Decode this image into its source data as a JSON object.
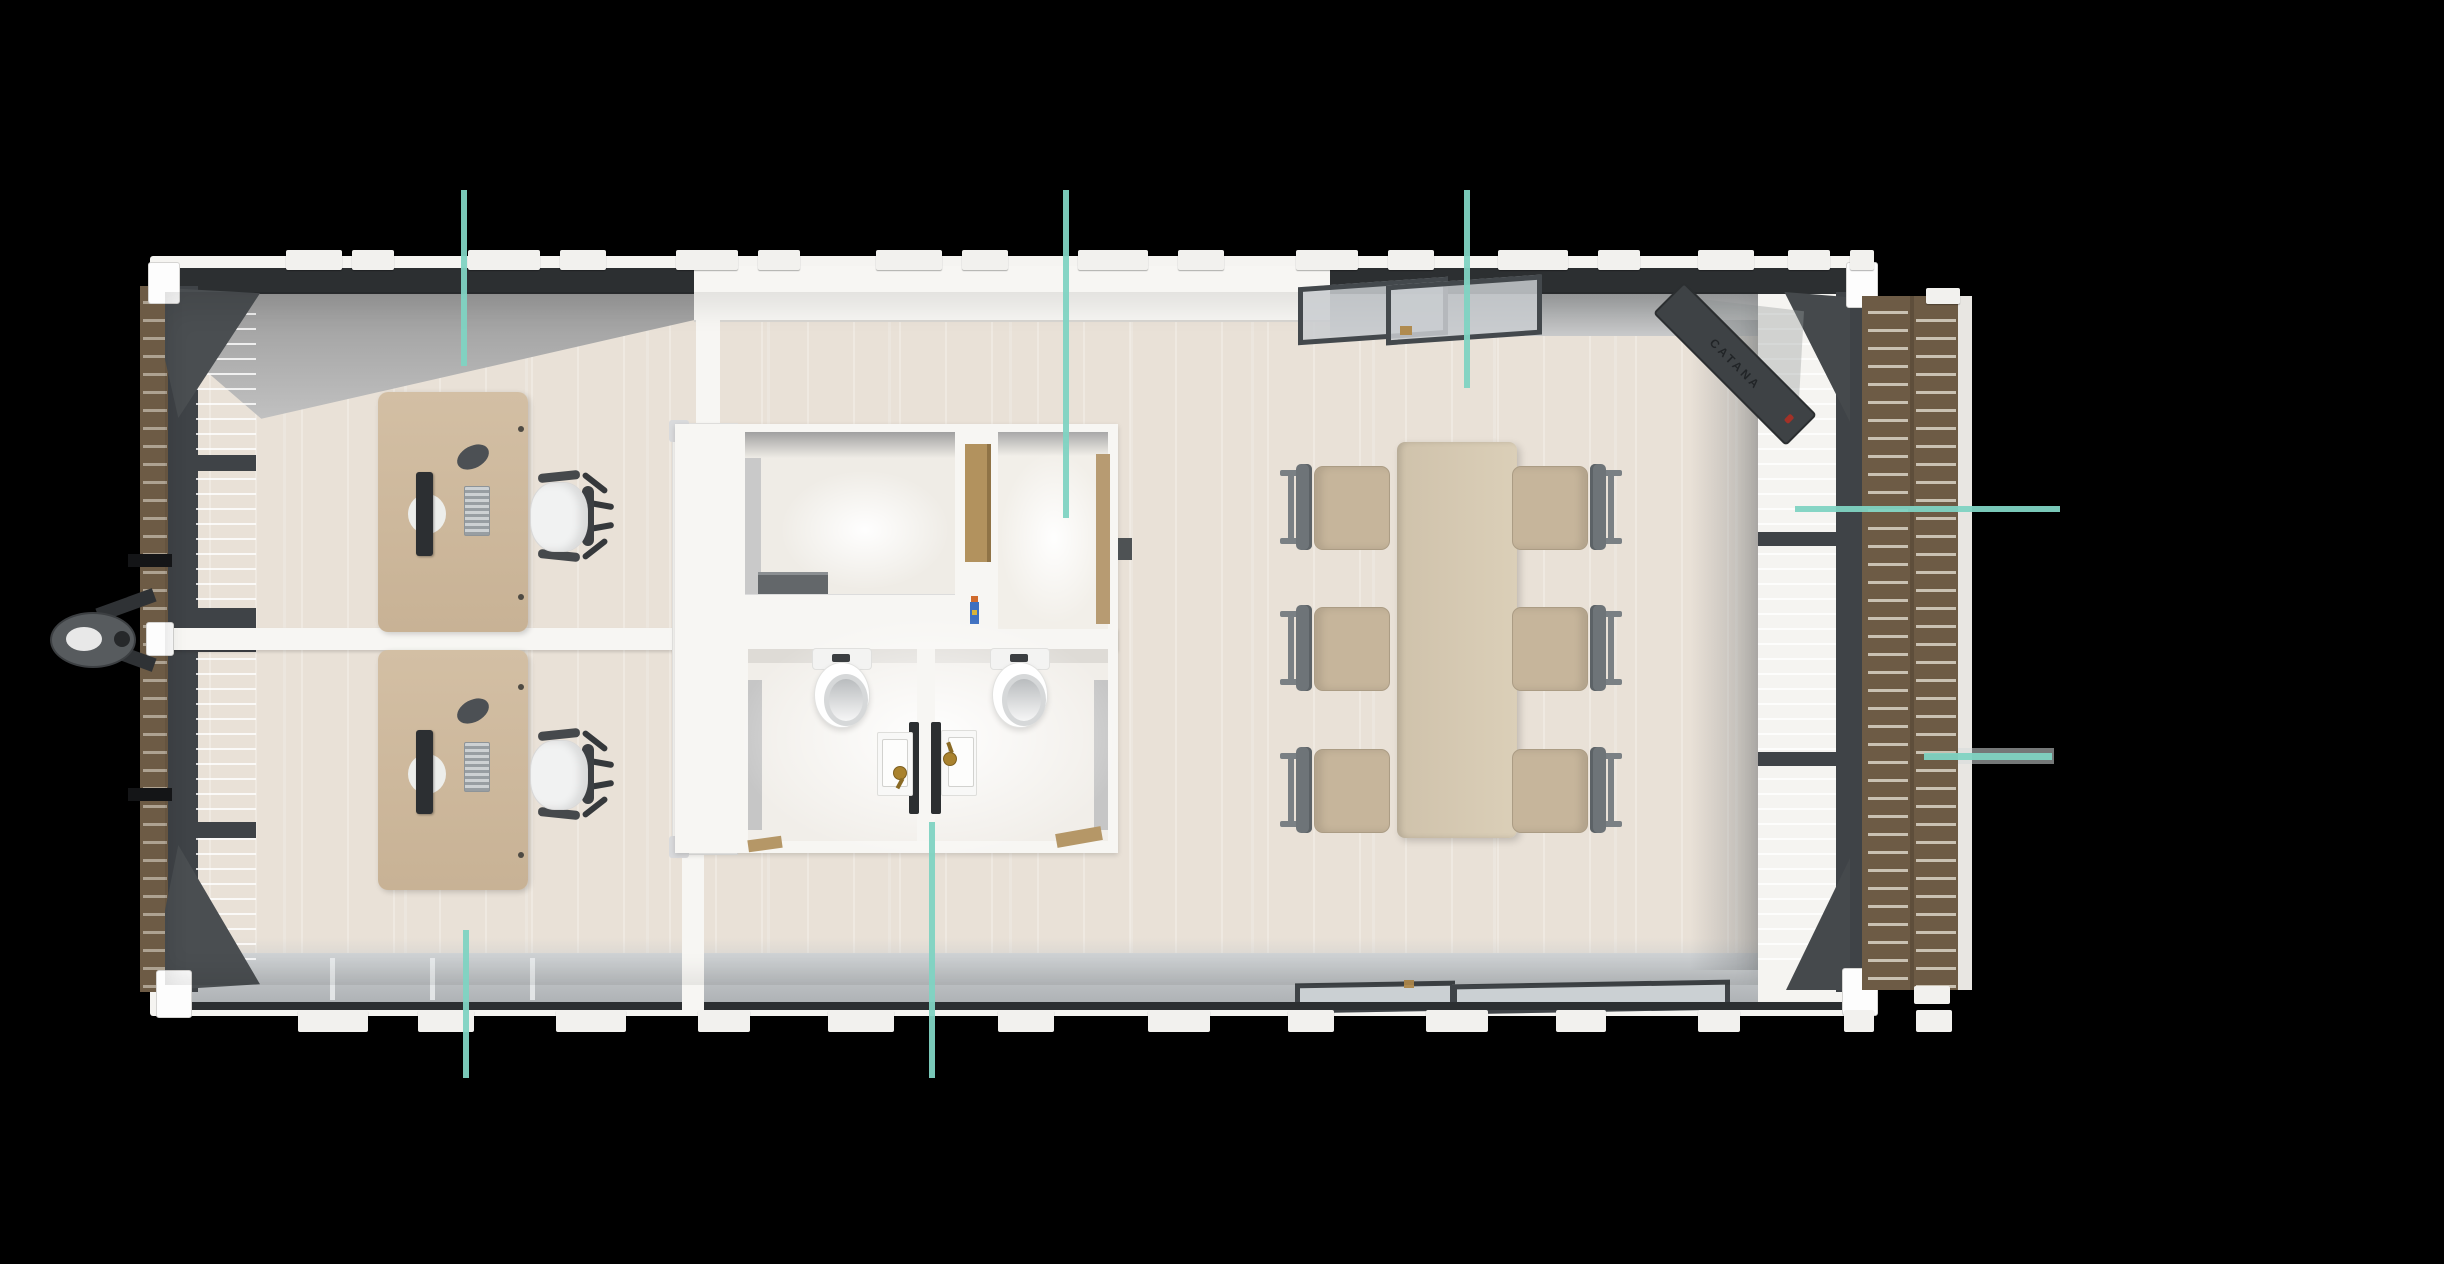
{
  "scene": {
    "type": "3d-floor-plan-top-view",
    "description": "Overhead 3D rendering of a prefab container office: two private offices with desks on the left, central restroom core with two WC stalls and twin sinks, open meeting area with table for six on the right, wood deck along the right side and a trailer hitch on the left.",
    "background_color": "#000000"
  },
  "colors": {
    "accent_teal": "#7fd3c2",
    "floor_cream": "#e9e1d7",
    "wall_white": "#f7f6f3",
    "wall_face_gray": "#b7babc",
    "frame_dark": "#3f4347",
    "glass_gray": "#d0d3d3",
    "deck_brown": "#6d5b45",
    "deck_plank_gap": "#c9c1b2",
    "desk_tan": "#cdb79b",
    "meeting_table_tan": "#d7cab2",
    "chair_seat_beige": "#c6b59b",
    "chair_frame_gray": "#70767a",
    "office_chair_white": "#f1f2f2",
    "faucet_brass": "#a9822e",
    "supply_bottle_blue": "#3d6fc0",
    "supply_bottle_cap": "#d06a2c"
  },
  "door": {
    "label": "CATANA"
  },
  "furniture_counts": {
    "office_desks": 2,
    "office_chairs": 2,
    "monitors": 2,
    "keyboards": 2,
    "mice": 2,
    "meeting_tables": 1,
    "meeting_chairs": 6,
    "toilets": 2,
    "sinks": 2,
    "faucets": 2
  },
  "callout_lines": [
    {
      "id": "callout-office-top",
      "orientation": "vertical",
      "x": 461,
      "y": 190,
      "length": 176,
      "thickness": 6
    },
    {
      "id": "callout-restroom-top",
      "orientation": "vertical",
      "x": 1063,
      "y": 190,
      "length": 328,
      "thickness": 6
    },
    {
      "id": "callout-meeting-top",
      "orientation": "vertical",
      "x": 1464,
      "y": 190,
      "length": 198,
      "thickness": 6
    },
    {
      "id": "callout-office-bottom",
      "orientation": "vertical",
      "x": 463,
      "y": 930,
      "length": 148,
      "thickness": 6
    },
    {
      "id": "callout-restroom-bottom",
      "orientation": "vertical",
      "x": 929,
      "y": 822,
      "length": 256,
      "thickness": 6
    },
    {
      "id": "callout-glass-wall-right",
      "orientation": "horizontal",
      "x": 1795,
      "y": 506,
      "length": 265,
      "thickness": 6
    },
    {
      "id": "callout-deck-right",
      "orientation": "horizontal",
      "x": 1924,
      "y": 753,
      "length": 128,
      "thickness": 7
    }
  ],
  "roof_tabs_top": [
    [
      286,
      56
    ],
    [
      352,
      42
    ],
    [
      468,
      72
    ],
    [
      560,
      46
    ],
    [
      676,
      62
    ],
    [
      758,
      42
    ],
    [
      876,
      66
    ],
    [
      962,
      46
    ],
    [
      1078,
      70
    ],
    [
      1178,
      46
    ],
    [
      1296,
      62
    ],
    [
      1388,
      46
    ],
    [
      1498,
      70
    ],
    [
      1598,
      42
    ],
    [
      1698,
      56
    ],
    [
      1788,
      42
    ],
    [
      1850,
      24
    ]
  ],
  "roof_tabs_bottom": [
    [
      298,
      70
    ],
    [
      418,
      56
    ],
    [
      556,
      70
    ],
    [
      698,
      52
    ],
    [
      828,
      66
    ],
    [
      998,
      56
    ],
    [
      1148,
      62
    ],
    [
      1288,
      46
    ],
    [
      1426,
      62
    ],
    [
      1556,
      50
    ],
    [
      1698,
      42
    ],
    [
      1844,
      30
    ],
    [
      1916,
      36
    ]
  ],
  "meeting_chairs": [
    {
      "x": 1280,
      "y": 462,
      "flip": false
    },
    {
      "x": 1280,
      "y": 603,
      "flip": false
    },
    {
      "x": 1280,
      "y": 745,
      "flip": false
    },
    {
      "x": 1512,
      "y": 462,
      "flip": true
    },
    {
      "x": 1512,
      "y": 603,
      "flip": true
    },
    {
      "x": 1512,
      "y": 745,
      "flip": true
    }
  ]
}
